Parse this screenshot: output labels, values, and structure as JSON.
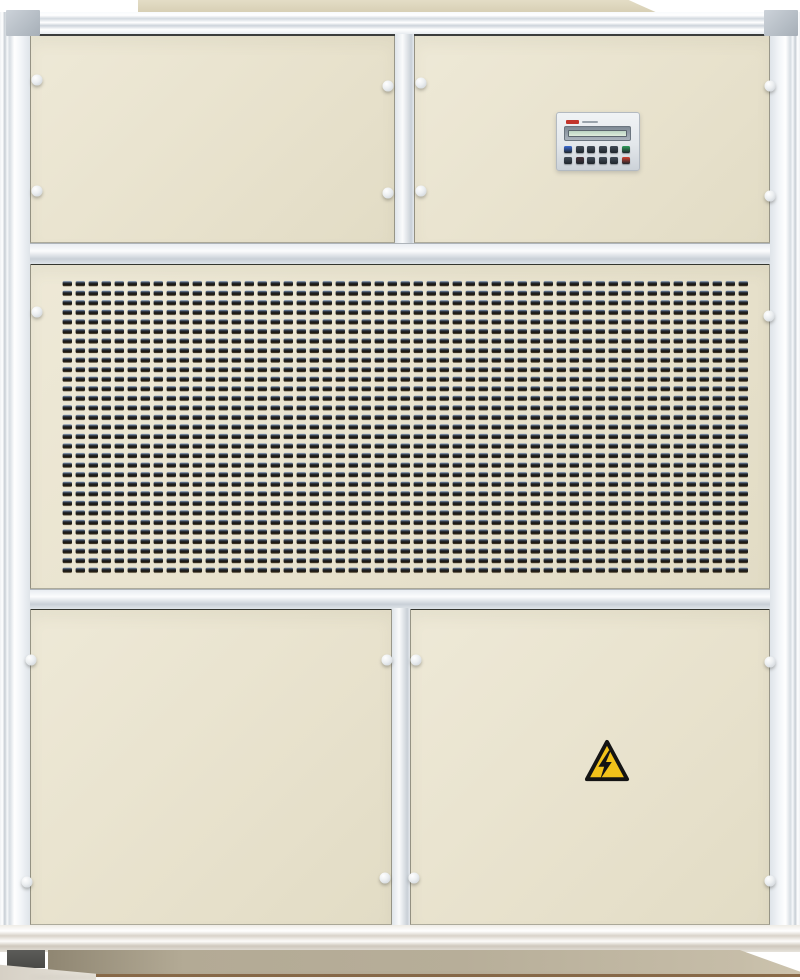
{
  "image": {
    "kind": "photograph",
    "subject": "packaged industrial air-handling / dehumidifier cabinet, front view"
  },
  "cabinet": {
    "panel_color": "#e8e2cd",
    "frame_color": "#f3f6f9",
    "grille": {
      "slot_color": "#1c1a15",
      "description": "perforated ventilation grille"
    },
    "base_color": "#b7ae99",
    "fastener_count": 18
  },
  "controller": {
    "body_color": "#e3e7eb",
    "brand_color": "#c2342b",
    "lcd_color": "#cfe2d2",
    "lcd_state": "blank",
    "button_rows": [
      [
        "#3a6bd4",
        "#424c58",
        "#424c58",
        "#424c58",
        "#424c58",
        "#2f9e5b"
      ],
      [
        "#424c58",
        "#47323a",
        "#424c58",
        "#424c58",
        "#424c58",
        "#d2402f"
      ]
    ]
  },
  "warning_label": {
    "symbol": "lightning-bolt",
    "bg": "#f2c21a",
    "border": "#141414"
  }
}
